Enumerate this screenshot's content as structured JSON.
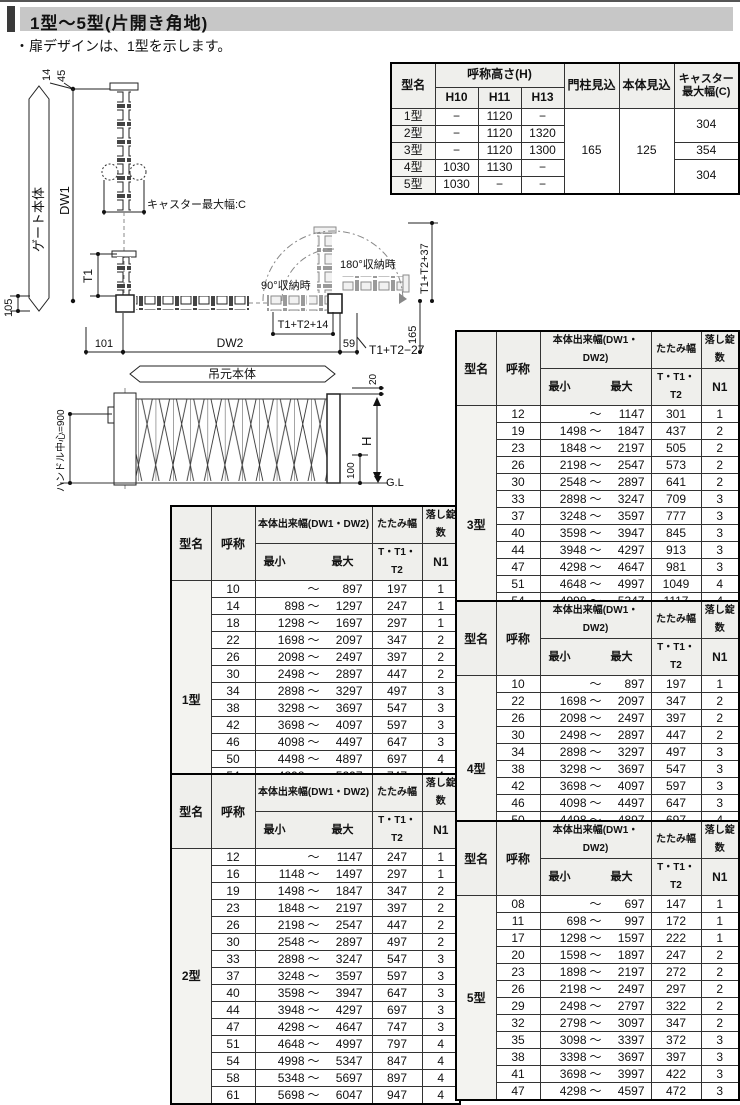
{
  "page": {
    "title": "1型〜5型(片開き角地)",
    "note": "・扉デザインは、1型を示します。"
  },
  "spec_table": {
    "col_model": "型名",
    "col_height": "呼称高さ(H)",
    "col_h10": "H10",
    "col_h11": "H11",
    "col_h13": "H13",
    "col_pillar": "門柱見込",
    "col_body": "本体見込",
    "col_caster": "キャスター最大幅(C)",
    "pillar": "165",
    "body": "125",
    "caster_12": "304",
    "caster_3": "354",
    "caster_45": "304",
    "rows": [
      {
        "model": "1型",
        "h10": "−",
        "h11": "1120",
        "h13": "−"
      },
      {
        "model": "2型",
        "h10": "−",
        "h11": "1120",
        "h13": "1320"
      },
      {
        "model": "3型",
        "h10": "−",
        "h11": "1120",
        "h13": "1300"
      },
      {
        "model": "4型",
        "h10": "1030",
        "h11": "1130",
        "h13": "−"
      },
      {
        "model": "5型",
        "h10": "1030",
        "h11": "−",
        "h13": "−"
      }
    ]
  },
  "diagram": {
    "dim_14": "14",
    "dim_45": "45",
    "gate_body": "ゲート本体",
    "dw1": "DW1",
    "caster_max": "キャスター最大幅:C",
    "t1": "T1",
    "dim_105": "105",
    "dim_101": "101",
    "dw2": "DW2",
    "dim_59": "59",
    "stored_90": "90°収納時",
    "stored_180": "180°収納時",
    "t1t2_14": "T1+T2+14",
    "t1t2_37": "T1+T2+37",
    "dim_165": "165",
    "t1t2_27": "T1+T2−27",
    "hinge_body": "吊元本体",
    "handle_center": "ハンドル中心=900",
    "dim_20": "20",
    "h": "H",
    "dim_100": "100",
    "gl": "G.L"
  },
  "size_table_headers": {
    "model": "型名",
    "name": "呼称",
    "width": "本体出来幅(DW1・DW2)",
    "min": "最小",
    "max": "最大",
    "tilde": "〜",
    "fold1": "たたみ幅",
    "fold2": "T・T1・T2",
    "lock1": "落し錠数",
    "lock2": "N1"
  },
  "size_tables": [
    {
      "model": "1型",
      "rows": [
        [
          "10",
          "",
          "897",
          "197",
          "1"
        ],
        [
          "14",
          "898",
          "1297",
          "247",
          "1"
        ],
        [
          "18",
          "1298",
          "1697",
          "297",
          "1"
        ],
        [
          "22",
          "1698",
          "2097",
          "347",
          "2"
        ],
        [
          "26",
          "2098",
          "2497",
          "397",
          "2"
        ],
        [
          "30",
          "2498",
          "2897",
          "447",
          "2"
        ],
        [
          "34",
          "2898",
          "3297",
          "497",
          "3"
        ],
        [
          "38",
          "3298",
          "3697",
          "547",
          "3"
        ],
        [
          "42",
          "3698",
          "4097",
          "597",
          "3"
        ],
        [
          "46",
          "4098",
          "4497",
          "647",
          "3"
        ],
        [
          "50",
          "4498",
          "4897",
          "697",
          "4"
        ],
        [
          "54",
          "4898",
          "5297",
          "747",
          "4"
        ],
        [
          "58",
          "5298",
          "5697",
          "797",
          "4"
        ],
        [
          "62",
          "5698",
          "6097",
          "847",
          "4"
        ]
      ]
    },
    {
      "model": "2型",
      "rows": [
        [
          "12",
          "",
          "1147",
          "247",
          "1"
        ],
        [
          "16",
          "1148",
          "1497",
          "297",
          "1"
        ],
        [
          "19",
          "1498",
          "1847",
          "347",
          "2"
        ],
        [
          "23",
          "1848",
          "2197",
          "397",
          "2"
        ],
        [
          "26",
          "2198",
          "2547",
          "447",
          "2"
        ],
        [
          "30",
          "2548",
          "2897",
          "497",
          "2"
        ],
        [
          "33",
          "2898",
          "3247",
          "547",
          "3"
        ],
        [
          "37",
          "3248",
          "3597",
          "597",
          "3"
        ],
        [
          "40",
          "3598",
          "3947",
          "647",
          "3"
        ],
        [
          "44",
          "3948",
          "4297",
          "697",
          "3"
        ],
        [
          "47",
          "4298",
          "4647",
          "747",
          "3"
        ],
        [
          "51",
          "4648",
          "4997",
          "797",
          "4"
        ],
        [
          "54",
          "4998",
          "5347",
          "847",
          "4"
        ],
        [
          "58",
          "5348",
          "5697",
          "897",
          "4"
        ],
        [
          "61",
          "5698",
          "6047",
          "947",
          "4"
        ]
      ]
    },
    {
      "model": "3型",
      "rows": [
        [
          "12",
          "",
          "1147",
          "301",
          "1"
        ],
        [
          "19",
          "1498",
          "1847",
          "437",
          "2"
        ],
        [
          "23",
          "1848",
          "2197",
          "505",
          "2"
        ],
        [
          "26",
          "2198",
          "2547",
          "573",
          "2"
        ],
        [
          "30",
          "2548",
          "2897",
          "641",
          "2"
        ],
        [
          "33",
          "2898",
          "3247",
          "709",
          "3"
        ],
        [
          "37",
          "3248",
          "3597",
          "777",
          "3"
        ],
        [
          "40",
          "3598",
          "3947",
          "845",
          "3"
        ],
        [
          "44",
          "3948",
          "4297",
          "913",
          "3"
        ],
        [
          "47",
          "4298",
          "4647",
          "981",
          "3"
        ],
        [
          "51",
          "4648",
          "4997",
          "1049",
          "4"
        ],
        [
          "54",
          "4998",
          "5347",
          "1117",
          "4"
        ],
        [
          "58",
          "5348",
          "5697",
          "1185",
          "4"
        ],
        [
          "61",
          "5698",
          "6047",
          "1253",
          "4"
        ]
      ]
    },
    {
      "model": "4型",
      "rows": [
        [
          "10",
          "",
          "897",
          "197",
          "1"
        ],
        [
          "22",
          "1698",
          "2097",
          "347",
          "2"
        ],
        [
          "26",
          "2098",
          "2497",
          "397",
          "2"
        ],
        [
          "30",
          "2498",
          "2897",
          "447",
          "2"
        ],
        [
          "34",
          "2898",
          "3297",
          "497",
          "3"
        ],
        [
          "38",
          "3298",
          "3697",
          "547",
          "3"
        ],
        [
          "42",
          "3698",
          "4097",
          "597",
          "3"
        ],
        [
          "46",
          "4098",
          "4497",
          "647",
          "3"
        ],
        [
          "50",
          "4498",
          "4897",
          "697",
          "4"
        ],
        [
          "54",
          "4898",
          "5297",
          "747",
          "4"
        ],
        [
          "58",
          "5298",
          "5697",
          "797",
          "4"
        ]
      ]
    },
    {
      "model": "5型",
      "rows": [
        [
          "08",
          "",
          "697",
          "147",
          "1"
        ],
        [
          "11",
          "698",
          "997",
          "172",
          "1"
        ],
        [
          "17",
          "1298",
          "1597",
          "222",
          "1"
        ],
        [
          "20",
          "1598",
          "1897",
          "247",
          "2"
        ],
        [
          "23",
          "1898",
          "2197",
          "272",
          "2"
        ],
        [
          "26",
          "2198",
          "2497",
          "297",
          "2"
        ],
        [
          "29",
          "2498",
          "2797",
          "322",
          "2"
        ],
        [
          "32",
          "2798",
          "3097",
          "347",
          "2"
        ],
        [
          "35",
          "3098",
          "3397",
          "372",
          "3"
        ],
        [
          "38",
          "3398",
          "3697",
          "397",
          "3"
        ],
        [
          "41",
          "3698",
          "3997",
          "422",
          "3"
        ],
        [
          "47",
          "4298",
          "4597",
          "472",
          "3"
        ]
      ]
    }
  ]
}
